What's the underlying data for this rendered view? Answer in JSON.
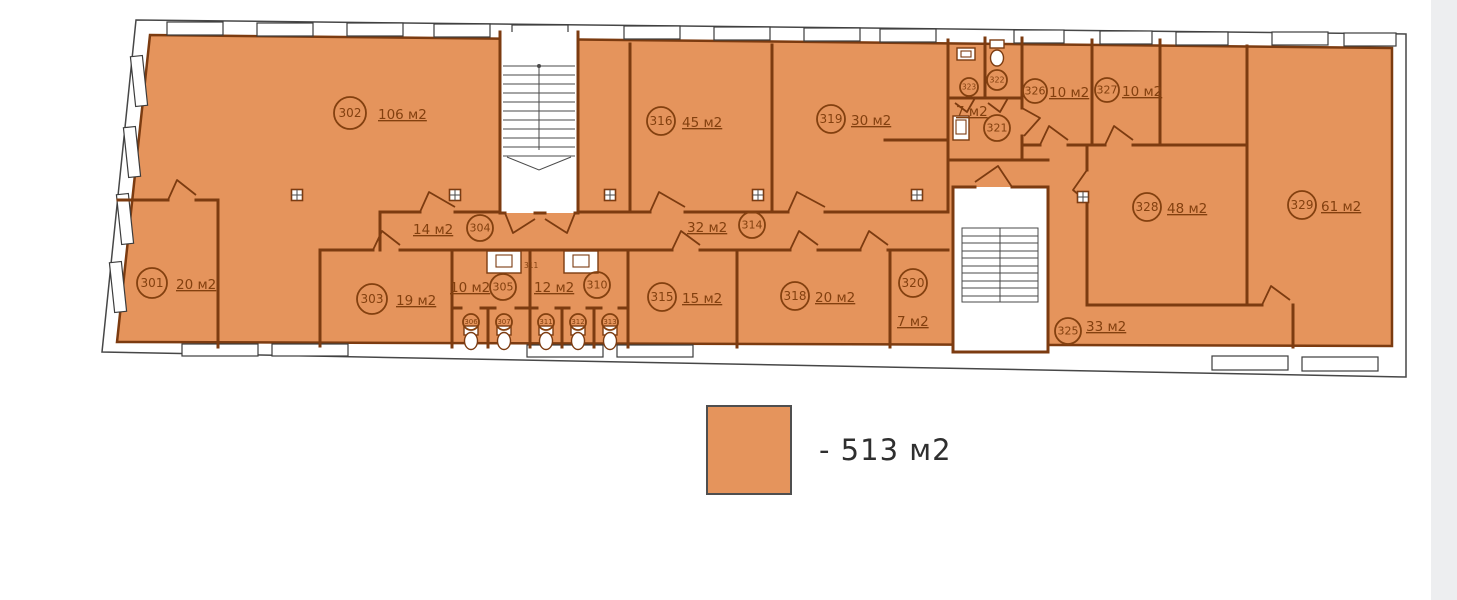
{
  "colors": {
    "fill": "#e5945c",
    "wall": "#7c3b10",
    "outline": "#474747",
    "text": "#83400f",
    "legend_text": "#2f2f2f"
  },
  "legend": {
    "label": "- 513 м2"
  },
  "rooms": [
    {
      "id": "301",
      "area": "20 м2",
      "cx": 152,
      "cy": 283,
      "r": 15,
      "lx": 176,
      "ly": 289
    },
    {
      "id": "302",
      "area": "106 м2",
      "cx": 350,
      "cy": 113,
      "r": 16,
      "lx": 378,
      "ly": 119
    },
    {
      "id": "303",
      "area": "19 м2",
      "cx": 372,
      "cy": 299,
      "r": 15,
      "lx": 396,
      "ly": 305
    },
    {
      "id": "304",
      "area": "14 м2",
      "cx": 480,
      "cy": 228,
      "r": 13,
      "lx": 413,
      "ly": 234
    },
    {
      "id": "305",
      "area": "10 м2",
      "cx": 503,
      "cy": 287,
      "r": 13,
      "lx": 450,
      "ly": 292
    },
    {
      "id": "310",
      "area": "12 м2",
      "cx": 597,
      "cy": 285,
      "r": 13,
      "lx": 534,
      "ly": 292
    },
    {
      "id": "314",
      "area": "32 м2",
      "cx": 752,
      "cy": 225,
      "r": 13,
      "lx": 687,
      "ly": 232
    },
    {
      "id": "315",
      "area": "15 м2",
      "cx": 662,
      "cy": 297,
      "r": 14,
      "lx": 682,
      "ly": 303
    },
    {
      "id": "316",
      "area": "45 м2",
      "cx": 661,
      "cy": 121,
      "r": 14,
      "lx": 682,
      "ly": 127
    },
    {
      "id": "318",
      "area": "20 м2",
      "cx": 795,
      "cy": 296,
      "r": 14,
      "lx": 815,
      "ly": 302
    },
    {
      "id": "319",
      "area": "30 м2",
      "cx": 831,
      "cy": 119,
      "r": 14,
      "lx": 851,
      "ly": 125
    },
    {
      "id": "320",
      "area": "7 м2",
      "cx": 913,
      "cy": 283,
      "r": 14,
      "lx": 897,
      "ly": 326
    },
    {
      "id": "321",
      "area": "7 м2",
      "cx": 997,
      "cy": 128,
      "r": 13,
      "lx": 956,
      "ly": 116
    },
    {
      "id": "325",
      "area": "33 м2",
      "cx": 1068,
      "cy": 331,
      "r": 13,
      "lx": 1086,
      "ly": 331
    },
    {
      "id": "326",
      "area": "10 м2",
      "cx": 1035,
      "cy": 91,
      "r": 12,
      "lx": 1049,
      "ly": 97
    },
    {
      "id": "327",
      "area": "10 м2",
      "cx": 1107,
      "cy": 90,
      "r": 12,
      "lx": 1122,
      "ly": 96
    },
    {
      "id": "328",
      "area": "48 м2",
      "cx": 1147,
      "cy": 207,
      "r": 14,
      "lx": 1167,
      "ly": 213
    },
    {
      "id": "329",
      "area": "61 м2",
      "cx": 1302,
      "cy": 205,
      "r": 14,
      "lx": 1321,
      "ly": 211
    }
  ],
  "small_rooms": [
    {
      "id": "306",
      "cx": 471,
      "cy": 322,
      "r": 8
    },
    {
      "id": "307",
      "cx": 504,
      "cy": 322,
      "r": 8
    },
    {
      "id": "311",
      "cx": 546,
      "cy": 322,
      "r": 8
    },
    {
      "id": "312",
      "cx": 578,
      "cy": 322,
      "r": 8
    },
    {
      "id": "313",
      "cx": 610,
      "cy": 322,
      "r": 8
    },
    {
      "id": "322",
      "cx": 997,
      "cy": 80,
      "r": 10
    },
    {
      "id": "323",
      "cx": 969,
      "cy": 87,
      "r": 9
    }
  ],
  "tiny_labels": [
    {
      "text": "311",
      "x": 524,
      "y": 268
    }
  ]
}
